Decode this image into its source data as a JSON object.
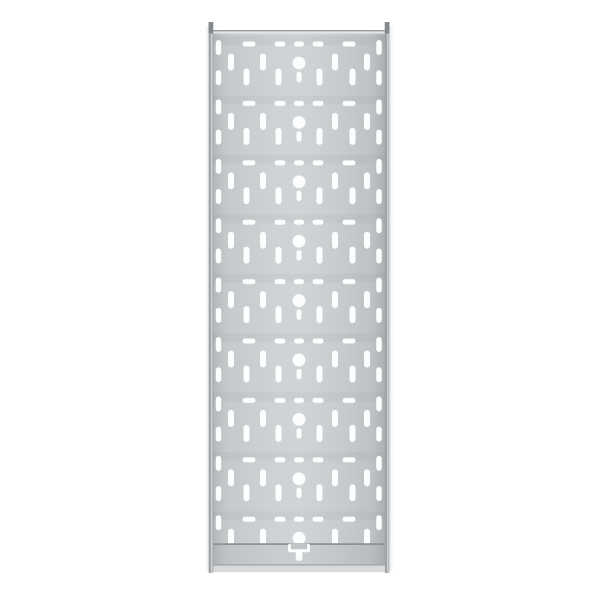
{
  "meta": {
    "description": "Top-down product photo of a galvanized perforated steel cable tray on a plain white background. No text is visible in the image.",
    "background_color": "#ffffff"
  },
  "tray": {
    "colors": {
      "hole": "#fcfdfd",
      "plate_gradient": [
        {
          "o": 0,
          "c": "#a2a7aa"
        },
        {
          "o": 0.012,
          "c": "#b5b9bc"
        },
        {
          "o": 0.08,
          "c": "#c6c9cb"
        },
        {
          "o": 0.35,
          "c": "#cfd2d4"
        },
        {
          "o": 0.5,
          "c": "#d1d4d6"
        },
        {
          "o": 0.68,
          "c": "#cbced1"
        },
        {
          "o": 0.92,
          "c": "#bfc2c5"
        },
        {
          "o": 0.988,
          "c": "#adb1b4"
        },
        {
          "o": 1,
          "c": "#999ea1"
        }
      ],
      "rail_gradient": [
        {
          "o": 0,
          "c": "#b4b8bb"
        },
        {
          "o": 0.28,
          "c": "#8e9296"
        },
        {
          "o": 0.62,
          "c": "#d6d8d9"
        },
        {
          "o": 1,
          "c": "#9fa4a7"
        }
      ],
      "rail_cap": "#84888b",
      "top_edge_dark": "#969b9e",
      "top_edge_light": "#e3e5e6",
      "band_line_top": "#8f9396",
      "band_line_bottom": "#a3a7aa",
      "band_tint": "rgba(40,45,50,0.03)",
      "fold": "#d7d9db",
      "row_shade": "rgba(85,90,95,0.05)",
      "shadow_outer": "rgba(150,155,158,0.20)",
      "tab_white": "#fbfcfc",
      "tab_gray": "#c2c5c8"
    },
    "plate": {
      "x": 212,
      "top_edge_y": 30,
      "pattern_y": 33.3,
      "width": 174,
      "pattern_height": 510.7,
      "band_top_y": 543.2,
      "band_bottom_y": 564.2,
      "fold_y": 565.8,
      "fold_height": 6.4,
      "center_x": 299
    },
    "rails": {
      "left_x": 208.6,
      "right_x": 384.8,
      "width": 4.6,
      "top_y": 22,
      "bottom_y": 573,
      "cap_height": 11.5
    },
    "pattern": {
      "rows": 9,
      "row_pitch": 59.4,
      "first_row_center_y": 63,
      "tile": {
        "width": 174,
        "height": 59.4,
        "circle": {
          "cx": 87,
          "cy": 29.7,
          "r": 6.4
        },
        "dashes": {
          "y": 8.2,
          "height": 5,
          "items": [
            {
              "x": 30.5,
              "w": 13
            },
            {
              "x": 62.5,
              "w": 11
            },
            {
              "x": 82.0,
              "w": 10
            },
            {
              "x": 100.5,
              "w": 11
            },
            {
              "x": 130.5,
              "w": 13
            }
          ]
        },
        "upper_slots": {
          "y": 20.2,
          "len": 17,
          "w": 6,
          "x": [
            16,
            48,
            120,
            152
          ]
        },
        "lower_slots": {
          "y": 35.2,
          "len": 17,
          "w": 6,
          "x": [
            31.5,
            63.5,
            104.5,
            137.5
          ]
        },
        "center_slot": {
          "x": 84.5,
          "y": 38.5,
          "w": 5,
          "len": 10.5
        },
        "edge_slots": {
          "w": 5.5,
          "len": 15,
          "x": [
            3.75,
            164.25
          ],
          "y": [
            6.7,
            36.9
          ]
        }
      }
    },
    "connector_tab": {
      "bar": {
        "x": 288,
        "y": 543.8,
        "w": 22,
        "h": 8.4,
        "rx": 2
      },
      "stem": {
        "x": 295.8,
        "y": 550,
        "w": 6.6,
        "h": 10.8,
        "rx": 2.4
      },
      "inner": {
        "x": 290.8,
        "y": 543.8,
        "w": 16.4,
        "h": 5.4,
        "rx": 1
      }
    }
  }
}
